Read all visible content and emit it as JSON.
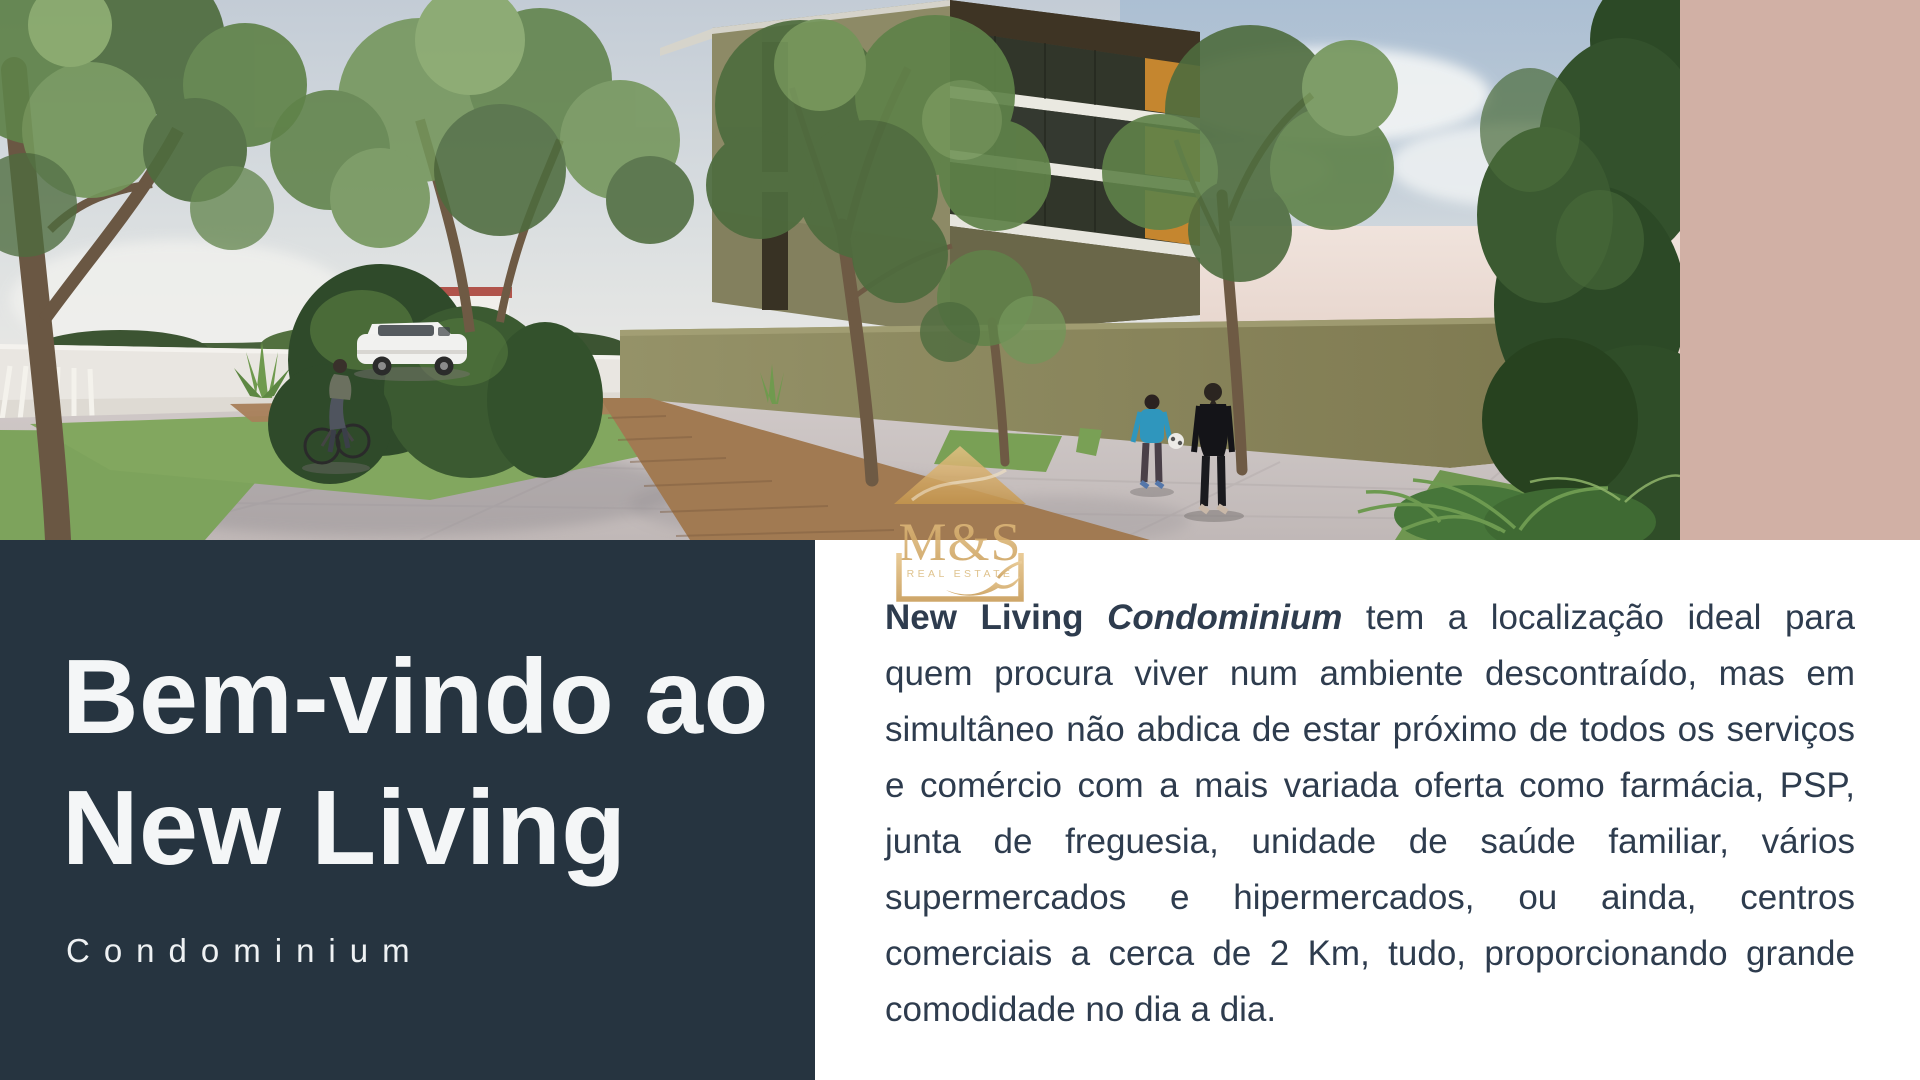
{
  "title": {
    "line1": "Bem-vindo ao",
    "line2": "New Living"
  },
  "subtitle": "Condominium",
  "logo": {
    "monogram": "M&S",
    "tagline": "REAL ESTATE"
  },
  "paragraph": {
    "lead": "New Living ",
    "lead_italic": "Condominium",
    "body": " tem a localização ideal para quem procura viver num ambiente descontraído, mas em simultâneo não abdica de estar próximo de todos os serviços e comércio com a mais variada oferta como farmácia, PSP, junta de freguesia, unidade de saúde familiar, vários supermercados e hipermercados, ou ainda, centros comerciais a cerca de 2 Km, tudo, proporcionando grande comodidade no dia a dia."
  },
  "colors": {
    "panel_navy": "#263440",
    "accent_rose_strip": "#d1b0a5",
    "logo_gold": "#cfa45e",
    "heading_text": "#f4f6f7",
    "body_text": "#2e3c4e",
    "building_olive": "#8d8a66",
    "balcony_orange": "#c5862f"
  }
}
